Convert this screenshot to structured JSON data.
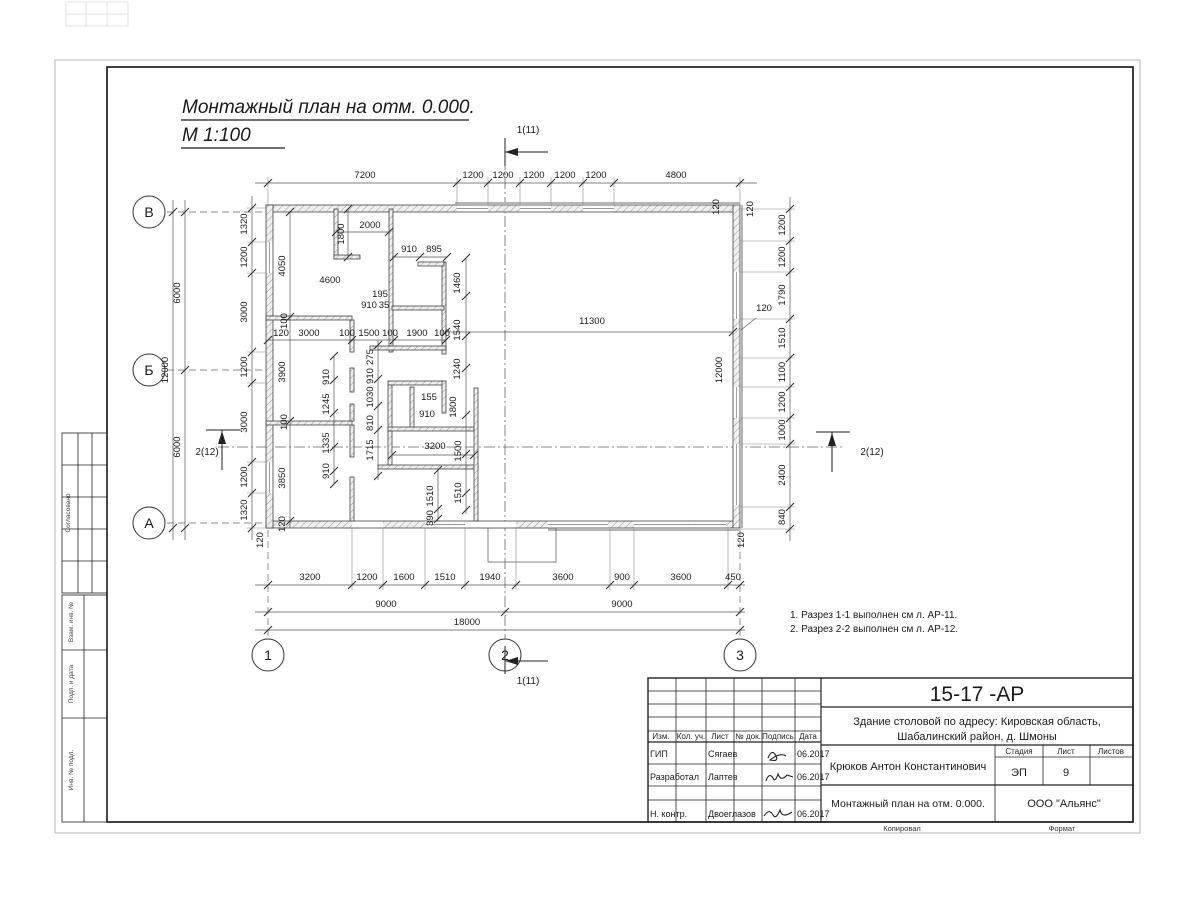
{
  "title": {
    "line1": "Монтажный план на отм. 0.000.",
    "line2": "М 1:100"
  },
  "notes": [
    "1. Разрез 1-1 выполнен см л. АР-11.",
    "2. Разрез 2-2 выполнен см л. АР-12."
  ],
  "axes": {
    "rows": [
      "В",
      "Б",
      "А"
    ],
    "cols": [
      "1",
      "2",
      "3"
    ]
  },
  "section_marks": {
    "top": "1(11)",
    "bottom": "1(11)",
    "left": "2(12)",
    "right": "2(12)"
  },
  "side_strips": [
    "Согласовано",
    "Взам. инв. №",
    "Подп. и дата",
    "Инв. № подл."
  ],
  "titleblock": {
    "doc_number": "15-17 -АР",
    "object_line1": "Здание столовой по адресу: Кировская область,",
    "object_line2": "Шабалинский район, д. Шмоны",
    "header_cols": [
      "Изм.",
      "Кол. уч.",
      "Лист",
      "№ док.",
      "Подпись",
      "Дата"
    ],
    "rows": [
      {
        "role": "ГИП",
        "name": "Сягаев",
        "date": "06.2017"
      },
      {
        "role": "Разработал",
        "name": "Лаптев",
        "date": "06.2017"
      },
      {
        "role": "Н. контр.",
        "name": "Двоеглазов",
        "date": "06.2017"
      }
    ],
    "chief": "Крюков Антон Константинович",
    "stage_label": "Стадия",
    "sheet_label": "Лист",
    "sheets_label": "Листов",
    "stage": "ЭП",
    "sheet": "9",
    "sheets": "",
    "drawing_title": "Монтажный план на отм. 0.000.",
    "company": "ООО \"Альянс\"",
    "copied": "Копировал",
    "format": "Формат"
  },
  "colors": {
    "line": "#1a1a1a",
    "wall_fill": "#efefef",
    "band": "#b5b5b5"
  },
  "plan": {
    "dim_labels": [
      {
        "x": 365,
        "y": 178,
        "t": "7200"
      },
      {
        "x": 473,
        "y": 178,
        "t": "1200"
      },
      {
        "x": 503,
        "y": 178,
        "t": "1200"
      },
      {
        "x": 534,
        "y": 178,
        "t": "1200"
      },
      {
        "x": 565,
        "y": 178,
        "t": "1200"
      },
      {
        "x": 596,
        "y": 178,
        "t": "1200"
      },
      {
        "x": 676,
        "y": 178,
        "t": "4800"
      },
      {
        "x": 719,
        "y": 207,
        "t": "120",
        "r": 1
      },
      {
        "x": 753,
        "y": 209,
        "t": "120",
        "r": 1
      },
      {
        "x": 785,
        "y": 225,
        "t": "1200",
        "r": 1
      },
      {
        "x": 785,
        "y": 257,
        "t": "1200",
        "r": 1
      },
      {
        "x": 785,
        "y": 295,
        "t": "1790",
        "r": 1
      },
      {
        "x": 785,
        "y": 338,
        "t": "1510",
        "r": 1
      },
      {
        "x": 785,
        "y": 372,
        "t": "1100",
        "r": 1
      },
      {
        "x": 785,
        "y": 402,
        "t": "1200",
        "r": 1
      },
      {
        "x": 785,
        "y": 430,
        "t": "1000",
        "r": 1
      },
      {
        "x": 785,
        "y": 475,
        "t": "2400",
        "r": 1
      },
      {
        "x": 785,
        "y": 517,
        "t": "840",
        "r": 1
      },
      {
        "x": 764,
        "y": 311,
        "t": "120"
      },
      {
        "x": 722,
        "y": 370,
        "t": "12000",
        "r": 1
      },
      {
        "x": 247,
        "y": 224,
        "t": "1320",
        "r": 1
      },
      {
        "x": 247,
        "y": 257,
        "t": "1200",
        "r": 1
      },
      {
        "x": 247,
        "y": 312,
        "t": "3000",
        "r": 1
      },
      {
        "x": 247,
        "y": 367,
        "t": "1200",
        "r": 1
      },
      {
        "x": 247,
        "y": 422,
        "t": "3000",
        "r": 1
      },
      {
        "x": 247,
        "y": 477,
        "t": "1200",
        "r": 1
      },
      {
        "x": 247,
        "y": 510,
        "t": "1320",
        "r": 1
      },
      {
        "x": 180,
        "y": 293,
        "t": "6000",
        "r": 1
      },
      {
        "x": 168,
        "y": 370,
        "t": "12000",
        "r": 1
      },
      {
        "x": 180,
        "y": 447,
        "t": "6000",
        "r": 1
      },
      {
        "x": 310,
        "y": 580,
        "t": "3200"
      },
      {
        "x": 367,
        "y": 580,
        "t": "1200"
      },
      {
        "x": 404,
        "y": 580,
        "t": "1600"
      },
      {
        "x": 445,
        "y": 580,
        "t": "1510"
      },
      {
        "x": 490,
        "y": 580,
        "t": "1940"
      },
      {
        "x": 563,
        "y": 580,
        "t": "3600"
      },
      {
        "x": 622,
        "y": 580,
        "t": "900"
      },
      {
        "x": 681,
        "y": 580,
        "t": "3600"
      },
      {
        "x": 733,
        "y": 580,
        "t": "450"
      },
      {
        "x": 386,
        "y": 607,
        "t": "9000"
      },
      {
        "x": 622,
        "y": 607,
        "t": "9000"
      },
      {
        "x": 467,
        "y": 625,
        "t": "18000"
      },
      {
        "x": 263,
        "y": 540,
        "t": "120",
        "r": 1
      },
      {
        "x": 744,
        "y": 540,
        "t": "120",
        "r": 1
      },
      {
        "x": 370,
        "y": 228,
        "t": "2000"
      },
      {
        "x": 344,
        "y": 234,
        "t": "1800",
        "r": 1
      },
      {
        "x": 285,
        "y": 266,
        "t": "4050",
        "r": 1
      },
      {
        "x": 330,
        "y": 283,
        "t": "4600"
      },
      {
        "x": 409,
        "y": 252,
        "t": "910"
      },
      {
        "x": 434,
        "y": 252,
        "t": "895"
      },
      {
        "x": 460,
        "y": 283,
        "t": "1460",
        "r": 1
      },
      {
        "x": 380,
        "y": 297,
        "t": "195"
      },
      {
        "x": 369,
        "y": 308,
        "t": "910"
      },
      {
        "x": 384,
        "y": 308,
        "t": "35"
      },
      {
        "x": 287,
        "y": 321,
        "t": "100",
        "r": 1
      },
      {
        "x": 281,
        "y": 336,
        "t": "120"
      },
      {
        "x": 309,
        "y": 336,
        "t": "3000"
      },
      {
        "x": 347,
        "y": 336,
        "t": "100"
      },
      {
        "x": 369,
        "y": 336,
        "t": "1500"
      },
      {
        "x": 390,
        "y": 336,
        "t": "100"
      },
      {
        "x": 417,
        "y": 336,
        "t": "1900"
      },
      {
        "x": 442,
        "y": 336,
        "t": "100"
      },
      {
        "x": 460,
        "y": 330,
        "t": "1540",
        "r": 1
      },
      {
        "x": 592,
        "y": 324,
        "t": "11300"
      },
      {
        "x": 285,
        "y": 372,
        "t": "3900",
        "r": 1
      },
      {
        "x": 329,
        "y": 377,
        "t": "910",
        "r": 1
      },
      {
        "x": 373,
        "y": 357,
        "t": "275",
        "r": 1
      },
      {
        "x": 373,
        "y": 376,
        "t": "910",
        "r": 1
      },
      {
        "x": 460,
        "y": 369,
        "t": "1240",
        "r": 1
      },
      {
        "x": 329,
        "y": 404,
        "t": "1245",
        "r": 1
      },
      {
        "x": 373,
        "y": 397,
        "t": "1030",
        "r": 1
      },
      {
        "x": 429,
        "y": 400,
        "t": "155"
      },
      {
        "x": 427,
        "y": 417,
        "t": "910"
      },
      {
        "x": 456,
        "y": 407,
        "t": "1800",
        "r": 1
      },
      {
        "x": 373,
        "y": 423,
        "t": "810",
        "r": 1
      },
      {
        "x": 287,
        "y": 422,
        "t": "100",
        "r": 1
      },
      {
        "x": 329,
        "y": 443,
        "t": "1335",
        "r": 1
      },
      {
        "x": 373,
        "y": 450,
        "t": "1715",
        "r": 1
      },
      {
        "x": 435,
        "y": 449,
        "t": "3200"
      },
      {
        "x": 461,
        "y": 451,
        "t": "1500",
        "r": 1
      },
      {
        "x": 285,
        "y": 478,
        "t": "3850",
        "r": 1
      },
      {
        "x": 329,
        "y": 471,
        "t": "910",
        "r": 1
      },
      {
        "x": 433,
        "y": 496,
        "t": "1510",
        "r": 1
      },
      {
        "x": 461,
        "y": 493,
        "t": "1510",
        "r": 1
      },
      {
        "x": 433,
        "y": 518,
        "t": "390",
        "r": 1
      },
      {
        "x": 285,
        "y": 524,
        "t": "120",
        "r": 1
      }
    ]
  }
}
